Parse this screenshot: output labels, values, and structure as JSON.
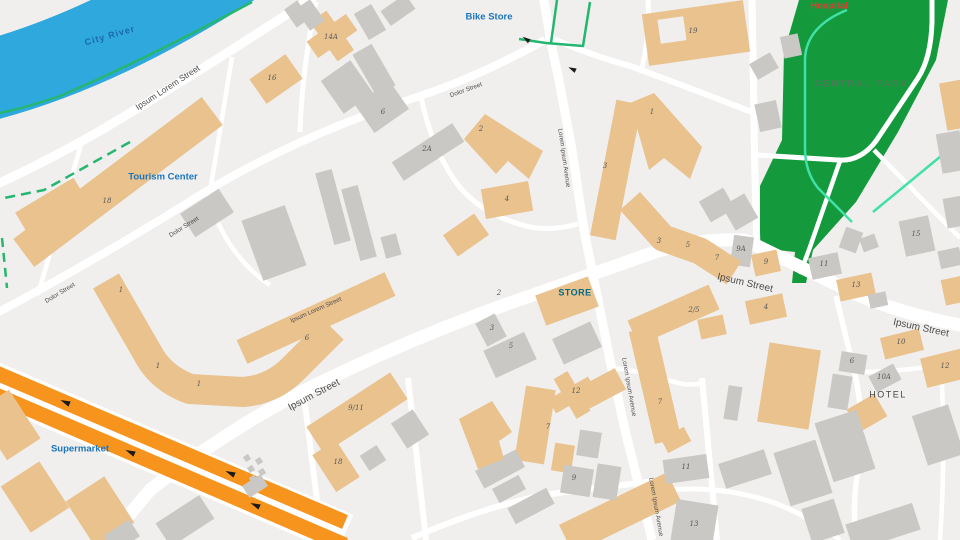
{
  "map": {
    "colors": {
      "bg": "#f0efed",
      "road": "#ffffff",
      "river": "#2fa8dd",
      "park": "#149a3d",
      "building_tan": "#e9c28e",
      "building_gray": "#c9c8c5",
      "highway": "#f7941e",
      "green_path": "#25b66f",
      "mint_path": "#41e0a7",
      "poi_blue": "#1b75bc",
      "hospital_red": "#e23c30",
      "store_teal": "#006b85",
      "park_text": "#4a7a55",
      "street_text": "#4d4d4d",
      "number_text": "#585858",
      "river_text": "#1a69ae",
      "hotel_text": "#454545",
      "arrow_black": "#1a1a1a"
    },
    "river": {
      "d": "M -30,85 Q 100,55 250,-45",
      "width": 80,
      "label": {
        "text": "City River",
        "x": 110,
        "y": 36,
        "rot": -16
      }
    },
    "park": {
      "outline": "M 799,0 L 948,0 L 936,60 L 898,132 L 856,202 L 813,250 L 806,283 L 792,283 L 795,252 L 760,248 L 760,186 L 782,140 L 784,52 Z",
      "label": {
        "text": "CENTRAL PARK",
        "x": 862,
        "y": 84
      },
      "white_paths": [
        {
          "d": "M 757,155 L 838,160 Q 860,162 876,141 L 918,78 Q 931,58 932,22 L 932,0",
          "w": 5
        },
        {
          "d": "M 841,158 L 810,247 L 800,274",
          "w": 4.5
        },
        {
          "d": "M 874,150 L 960,238",
          "w": 4.5
        }
      ],
      "mint_paths": [
        {
          "d": "M 847,10 Q 807,26 805,58 L 805,148 Q 805,172 818,188 L 852,222"
        },
        {
          "d": "M 958,142 L 873,212"
        }
      ]
    },
    "roads": [
      {
        "d": "M 318,-6 Q 215,62 110,125 Q 50,160 -5,185",
        "w": 9
      },
      {
        "d": "M -5,314 Q 100,258 205,192 Q 300,135 420,96 Q 480,76 545,40",
        "w": 8
      },
      {
        "d": "M 82,141 L 38,295",
        "w": 4.5
      },
      {
        "d": "M 232,57 L 210,192",
        "w": 4.5
      },
      {
        "d": "M 316,2 Q 302,70 300,132",
        "w": 5
      },
      {
        "d": "M 206,191 Q 225,255 270,285",
        "w": 4.5
      },
      {
        "d": "M 421,97 Q 432,150 458,185 Q 483,216 530,227 Q 552,231 578,224",
        "w": 5
      },
      {
        "d": "M 546,36 Q 590,55 630,66 Q 690,88 752,112",
        "w": 6
      },
      {
        "d": "M 642,68 Q 650,35 648,0",
        "w": 5
      },
      {
        "d": "M 543,-5 L 549,30 Q 552,50 558,75 L 572,150 L 584,230 L 596,290 L 610,360 L 625,430 L 640,490 L 652,540",
        "w": 9
      },
      {
        "d": "M 752,-5 L 754,120 Q 755,190 757,247",
        "w": 7
      },
      {
        "d": "M 108,540 L 150,490 Q 240,420 330,378 Q 430,330 530,296 Q 610,268 655,252 Q 700,238 745,240 Q 790,262 860,296 Q 910,316 965,326",
        "w": 13
      },
      {
        "d": "M 304,396 L 322,540",
        "w": 6
      },
      {
        "d": "M 408,378 L 426,540",
        "w": 6
      },
      {
        "d": "M 412,538 Q 500,500 565,492 L 680,478",
        "w": 6
      },
      {
        "d": "M 612,368 Q 648,372 668,380 Q 690,388 704,382",
        "w": 4.5
      },
      {
        "d": "M 702,378 L 717,540",
        "w": 6
      },
      {
        "d": "M 645,492 Q 720,482 780,505 Q 815,520 840,540",
        "w": 5
      },
      {
        "d": "M 836,296 L 854,370 Q 866,420 858,470 Q 852,505 856,540",
        "w": 5.5
      },
      {
        "d": "M 854,372 Q 900,372 940,365 Q 952,362 965,366",
        "w": 4.5
      },
      {
        "d": "M 941,366 Q 946,450 940,540",
        "w": 4.5
      }
    ],
    "green_lines": [
      {
        "d": "M 252,2 Q 140,62 60,96 Q 25,108 -5,114",
        "dash": ""
      },
      {
        "d": "M 130,142 L 44,190 L 4,198",
        "dash": "10 6"
      },
      {
        "d": "M 2,238 L 7,288",
        "dash": "9 6"
      },
      {
        "d": "M 519,39 L 546,43 L 583,46 L 590,2",
        "dash": ""
      },
      {
        "d": "M 551,43 L 557,0",
        "dash": ""
      }
    ],
    "highway": {
      "casing": {
        "d": "M -20,377 L 345,534",
        "w": 42
      },
      "lanes": [
        {
          "d": "M -20,366 L 345,522",
          "w": 15
        },
        {
          "d": "M -20,388 L 345,545",
          "w": 15
        }
      ],
      "arrows": [
        {
          "x": 65,
          "y": 402,
          "rot": 24
        },
        {
          "x": 230,
          "y": 473,
          "rot": 24
        },
        {
          "x": 130,
          "y": 452,
          "rot": 24
        },
        {
          "x": 255,
          "y": 505,
          "rot": 24
        }
      ]
    },
    "junction_arrows": [
      {
        "x": 526,
        "y": 39,
        "rot": 35
      },
      {
        "x": 572,
        "y": 69,
        "rot": 25
      }
    ],
    "buildings": [
      [
        52,
        208,
        68,
        30,
        -31,
        "t"
      ],
      [
        118,
        182,
        236,
        35,
        -37,
        "t"
      ],
      [
        276,
        79,
        44,
        30,
        -35,
        "t"
      ],
      [
        332,
        36,
        48,
        20,
        -35,
        "t"
      ],
      [
        332,
        36,
        20,
        48,
        -35,
        "t"
      ],
      [
        567,
        301,
        56,
        32,
        -20,
        "t"
      ],
      [
        357,
        413,
        100,
        32,
        -33,
        "t"
      ],
      [
        336,
        466,
        28,
        44,
        -33,
        "t"
      ],
      [
        507,
        200,
        48,
        30,
        -10,
        "t"
      ],
      [
        466,
        235,
        38,
        26,
        -35,
        "t"
      ],
      [
        856,
        287,
        36,
        22,
        -12,
        "t"
      ],
      [
        766,
        263,
        26,
        22,
        -12,
        "t"
      ],
      [
        766,
        309,
        38,
        24,
        -12,
        "t"
      ],
      [
        902,
        344,
        40,
        22,
        -14,
        "t"
      ],
      [
        945,
        368,
        44,
        30,
        -14,
        "t"
      ],
      [
        867,
        413,
        32,
        26,
        -30,
        "t"
      ],
      [
        620,
        513,
        120,
        32,
        -26,
        "t"
      ],
      [
        35,
        497,
        46,
        55,
        -33,
        "t"
      ],
      [
        100,
        512,
        46,
        55,
        -33,
        "t"
      ],
      [
        8,
        425,
        40,
        58,
        -33,
        "t"
      ],
      [
        572,
        395,
        46,
        16,
        -30,
        "t"
      ],
      [
        572,
        395,
        16,
        46,
        -30,
        "t"
      ],
      [
        535,
        425,
        30,
        75,
        9,
        "t"
      ],
      [
        563,
        458,
        20,
        28,
        9,
        "t"
      ],
      [
        789,
        386,
        52,
        80,
        9,
        "t"
      ],
      [
        696,
        33,
        102,
        52,
        -8,
        "t"
      ],
      [
        616,
        170,
        26,
        138,
        11,
        "t"
      ],
      [
        676,
        440,
        26,
        16,
        -28,
        "t"
      ],
      [
        712,
        327,
        26,
        20,
        -12,
        "t"
      ],
      [
        955,
        105,
        24,
        48,
        -10,
        "t"
      ],
      [
        957,
        290,
        28,
        26,
        -12,
        "t"
      ],
      [
        601,
        389,
        44,
        24,
        -28,
        "t"
      ],
      [
        297,
        14,
        16,
        22,
        -35,
        "g"
      ],
      [
        310,
        15,
        18,
        26,
        -35,
        "g"
      ],
      [
        398,
        10,
        30,
        18,
        -35,
        "g"
      ],
      [
        370,
        22,
        20,
        30,
        -30,
        "g"
      ],
      [
        374,
        70,
        22,
        48,
        -30,
        "g"
      ],
      [
        363,
        101,
        14,
        16,
        -30,
        "g"
      ],
      [
        347,
        87,
        36,
        40,
        -35,
        "g"
      ],
      [
        382,
        107,
        42,
        34,
        -35,
        "g"
      ],
      [
        428,
        152,
        72,
        22,
        -33,
        "g"
      ],
      [
        207,
        213,
        46,
        28,
        -33,
        "g"
      ],
      [
        274,
        243,
        46,
        64,
        -20,
        "g"
      ],
      [
        333,
        207,
        17,
        74,
        -15,
        "g"
      ],
      [
        359,
        223,
        17,
        74,
        -15,
        "g"
      ],
      [
        391,
        246,
        16,
        22,
        -15,
        "g"
      ],
      [
        410,
        429,
        26,
        30,
        -33,
        "g"
      ],
      [
        373,
        458,
        20,
        18,
        -33,
        "g"
      ],
      [
        255,
        486,
        22,
        14,
        -33,
        "g"
      ],
      [
        185,
        521,
        52,
        28,
        -33,
        "g"
      ],
      [
        122,
        536,
        30,
        20,
        -33,
        "g"
      ],
      [
        500,
        469,
        46,
        20,
        -28,
        "g"
      ],
      [
        509,
        489,
        30,
        16,
        -28,
        "g"
      ],
      [
        531,
        506,
        44,
        18,
        -28,
        "g"
      ],
      [
        589,
        444,
        22,
        26,
        9,
        "g"
      ],
      [
        577,
        481,
        30,
        28,
        9,
        "g"
      ],
      [
        607,
        482,
        24,
        34,
        9,
        "g"
      ],
      [
        686,
        469,
        44,
        24,
        -8,
        "g"
      ],
      [
        694,
        526,
        42,
        48,
        9,
        "g"
      ],
      [
        745,
        469,
        48,
        26,
        -18,
        "g"
      ],
      [
        803,
        473,
        44,
        56,
        -18,
        "g"
      ],
      [
        845,
        446,
        44,
        62,
        -18,
        "g"
      ],
      [
        938,
        435,
        38,
        52,
        -18,
        "g"
      ],
      [
        823,
        521,
        34,
        36,
        -18,
        "g"
      ],
      [
        883,
        527,
        70,
        28,
        -18,
        "g"
      ],
      [
        740,
        212,
        26,
        28,
        -30,
        "g"
      ],
      [
        717,
        205,
        28,
        24,
        -30,
        "g"
      ],
      [
        742,
        251,
        20,
        30,
        8,
        "g"
      ],
      [
        825,
        266,
        30,
        22,
        -12,
        "g"
      ],
      [
        917,
        236,
        30,
        36,
        -12,
        "g"
      ],
      [
        851,
        240,
        18,
        22,
        20,
        "g"
      ],
      [
        869,
        243,
        16,
        14,
        -20,
        "g"
      ],
      [
        878,
        300,
        18,
        14,
        -12,
        "g"
      ],
      [
        853,
        363,
        26,
        20,
        9,
        "g"
      ],
      [
        840,
        392,
        20,
        34,
        9,
        "g"
      ],
      [
        885,
        378,
        28,
        18,
        -28,
        "g"
      ],
      [
        764,
        66,
        24,
        18,
        -30,
        "g"
      ],
      [
        768,
        116,
        22,
        28,
        -12,
        "g"
      ],
      [
        791,
        46,
        18,
        22,
        -12,
        "g"
      ],
      [
        951,
        152,
        24,
        40,
        -10,
        "g"
      ],
      [
        955,
        212,
        20,
        30,
        -10,
        "g"
      ],
      [
        733,
        403,
        14,
        34,
        9,
        "g"
      ],
      [
        950,
        258,
        22,
        18,
        -12,
        "g"
      ],
      [
        491,
        330,
        22,
        26,
        -28,
        "g"
      ],
      [
        510,
        355,
        45,
        30,
        -25,
        "g"
      ],
      [
        577,
        343,
        42,
        28,
        -25,
        "g"
      ]
    ],
    "building_bars": [
      {
        "d": "M 106,281 L 147,352 Q 160,378 190,389 L 243,392 Q 272,390 293,369 L 333,329",
        "w": 30,
        "c": "t"
      },
      {
        "d": "M 242,352 L 390,284",
        "w": 26,
        "c": "t"
      },
      {
        "d": "M 630,201 L 663,238 L 700,251 L 734,273",
        "w": 27,
        "c": "t"
      },
      {
        "d": "M 633,333 L 714,297",
        "w": 27,
        "c": "t"
      },
      {
        "d": "M 642,329 L 668,441",
        "w": 27,
        "c": "t"
      }
    ],
    "building_polys": [
      {
        "pts": "630,103 654,93 702,147 690,179 664,158 649,170",
        "c": "t"
      },
      {
        "pts": "464,139 485,114 543,151 529,179 508,161 496,174",
        "c": "t"
      },
      {
        "pts": "459,419 492,401 512,432 499,441 504,459 478,469",
        "c": "t"
      }
    ],
    "building_notches": [
      [
        672,
        30,
        26,
        24,
        -8
      ]
    ],
    "dots": [
      [
        247,
        458
      ],
      [
        259,
        461
      ],
      [
        251,
        469
      ],
      [
        262,
        472
      ],
      [
        253,
        479
      ]
    ],
    "pois": [
      {
        "text": "Tourism Center",
        "x": 163,
        "y": 177,
        "size": 9.5,
        "color": "poi_blue",
        "weight": "bold",
        "ls": 0
      },
      {
        "text": "Bike Store",
        "x": 489,
        "y": 17,
        "size": 9.5,
        "color": "poi_blue",
        "weight": "bold",
        "ls": 0
      },
      {
        "text": "Supermarket",
        "x": 80,
        "y": 449,
        "size": 9.5,
        "color": "poi_blue",
        "weight": "bold",
        "ls": 0
      },
      {
        "text": "Hospital",
        "x": 829,
        "y": 6,
        "size": 9.5,
        "color": "hospital_red",
        "weight": "600",
        "ls": 0
      },
      {
        "text": "STORE",
        "x": 575,
        "y": 293,
        "size": 9,
        "color": "store_teal",
        "weight": "bold",
        "ls": 0.5
      },
      {
        "text": "HOTEL",
        "x": 888,
        "y": 395,
        "size": 9,
        "color": "hotel_text",
        "weight": "normal",
        "ls": 1.5
      }
    ],
    "street_labels": [
      {
        "text": "Ipsum Lorem Street",
        "x": 168,
        "y": 88,
        "rot": -33,
        "size": 8.5
      },
      {
        "text": "Dolor Street",
        "x": 466,
        "y": 90,
        "rot": -20,
        "size": 6.3
      },
      {
        "text": "Dolor Street",
        "x": 184,
        "y": 227,
        "rot": -32,
        "size": 6.3
      },
      {
        "text": "Dolor Street",
        "x": 60,
        "y": 293,
        "rot": -31,
        "size": 6.3
      },
      {
        "text": "Ipsum Lorem Street",
        "x": 316,
        "y": 310,
        "rot": -24,
        "size": 6.3
      },
      {
        "text": "Ipsum Street",
        "x": 314,
        "y": 395,
        "rot": -28,
        "size": 10
      },
      {
        "text": "Ipsum Street",
        "x": 745,
        "y": 283,
        "rot": 13,
        "size": 10
      },
      {
        "text": "Ipsum Street",
        "x": 921,
        "y": 328,
        "rot": 12,
        "size": 10
      },
      {
        "text": "Lorem Ipsum Avenue",
        "x": 564,
        "y": 158,
        "rot": 82,
        "size": 6.3
      },
      {
        "text": "Lorem Ipsum Avenue",
        "x": 629,
        "y": 387,
        "rot": 80,
        "size": 6.3
      },
      {
        "text": "Lorem Ipsum Avenue",
        "x": 656,
        "y": 507,
        "rot": 80,
        "size": 6.3
      }
    ],
    "numbers": [
      [
        "16",
        272,
        78
      ],
      [
        "14A",
        331,
        37
      ],
      [
        "18",
        107,
        201
      ],
      [
        "6",
        383,
        112
      ],
      [
        "2A",
        427,
        149
      ],
      [
        "2",
        481,
        129
      ],
      [
        "4",
        507,
        199
      ],
      [
        "2",
        499,
        293
      ],
      [
        "3",
        492,
        328
      ],
      [
        "5",
        511,
        346
      ],
      [
        "12",
        576,
        391
      ],
      [
        "7",
        548,
        427
      ],
      [
        "9",
        574,
        478
      ],
      [
        "18",
        338,
        462
      ],
      [
        "9/11",
        356,
        408
      ],
      [
        "1",
        121,
        290
      ],
      [
        "1",
        158,
        366
      ],
      [
        "1",
        199,
        384
      ],
      [
        "6",
        307,
        338
      ],
      [
        "3",
        605,
        166
      ],
      [
        "1",
        652,
        112
      ],
      [
        "19",
        693,
        31
      ],
      [
        "3",
        659,
        241
      ],
      [
        "5",
        688,
        245
      ],
      [
        "7",
        717,
        258
      ],
      [
        "9A",
        741,
        249
      ],
      [
        "9",
        766,
        262
      ],
      [
        "11",
        824,
        264
      ],
      [
        "15",
        916,
        234
      ],
      [
        "13",
        856,
        285
      ],
      [
        "4",
        766,
        307
      ],
      [
        "2/5",
        694,
        310
      ],
      [
        "7",
        660,
        402
      ],
      [
        "11",
        686,
        467
      ],
      [
        "13",
        694,
        524
      ],
      [
        "10",
        901,
        342
      ],
      [
        "12",
        945,
        366
      ],
      [
        "10A",
        884,
        377
      ],
      [
        "6",
        852,
        361
      ]
    ]
  }
}
